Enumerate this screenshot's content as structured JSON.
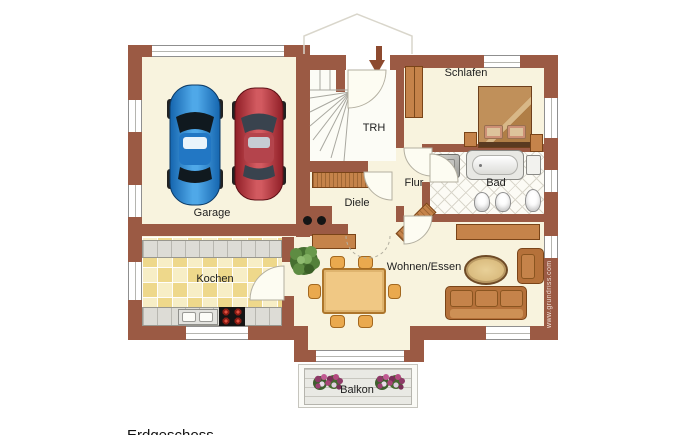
{
  "caption": "Erdgeschoss",
  "watermark": "www.grundriss.com",
  "rooms": {
    "garage": "Garage",
    "stairwell": "TRH",
    "bedroom": "Schlafen",
    "hallway": "Flur",
    "bathroom": "Bad",
    "foyer": "Diele",
    "kitchen": "Kochen",
    "living_dining": "Wohnen/Essen",
    "balcony": "Balkon"
  },
  "colors": {
    "wall": "#9b5a44",
    "floor": "#f8f3de",
    "kitchen_tile": "#eed88b",
    "furniture_wood": "#c5834a",
    "car_blue": "#2a86d6",
    "car_red": "#c04048"
  }
}
